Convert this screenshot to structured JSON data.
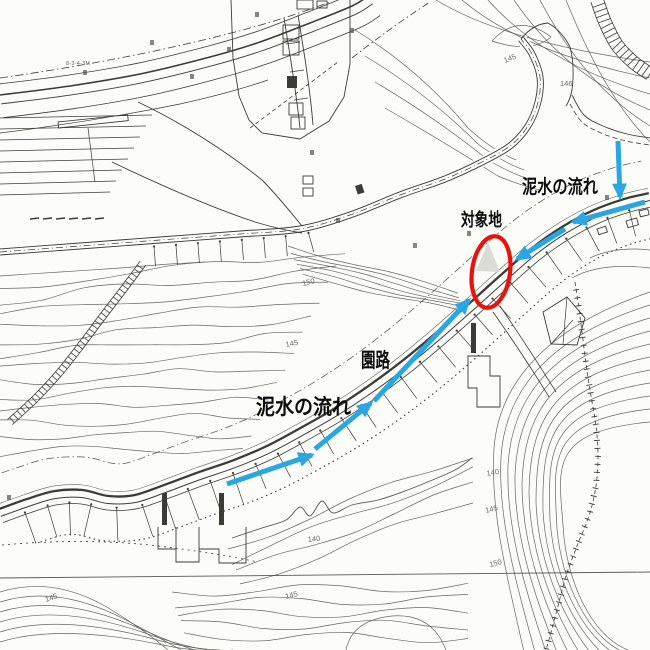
{
  "colors": {
    "paper": "#fcfcf9",
    "ink": "#3c3c36",
    "contour": "#5a5a52",
    "flow_arrow": "#2aa7e2",
    "target_circle": "#e7130e",
    "label_text": "#0d0d0d",
    "contour_label": "#6e6e65",
    "triangle_fill": "#dcdcd6"
  },
  "annotations": {
    "flow_labels": [
      {
        "id": "mud-flow-upper",
        "text": "泥水の流れ",
        "x": 522,
        "y": 193,
        "size": 19,
        "length": 76
      },
      {
        "id": "target-site",
        "text": "対象地",
        "x": 461,
        "y": 226,
        "size": 18,
        "length": 41
      },
      {
        "id": "park-path",
        "text": "園路",
        "x": 361,
        "y": 367,
        "size": 20,
        "length": 29
      },
      {
        "id": "mud-flow-lower",
        "text": "泥水の流れ",
        "x": 256,
        "y": 414,
        "size": 21,
        "length": 95
      }
    ],
    "flow_arrows": [
      {
        "x1": 618,
        "y1": 141,
        "x2": 620,
        "y2": 197
      },
      {
        "x1": 645,
        "y1": 202,
        "x2": 573,
        "y2": 222
      },
      {
        "x1": 565,
        "y1": 229,
        "x2": 517,
        "y2": 259
      },
      {
        "x1": 374,
        "y1": 401,
        "x2": 469,
        "y2": 300
      },
      {
        "x1": 315,
        "y1": 449,
        "x2": 371,
        "y2": 403
      },
      {
        "x1": 227,
        "y1": 484,
        "x2": 312,
        "y2": 455
      }
    ],
    "target_circle": {
      "cx": 491,
      "cy": 272,
      "rx": 19,
      "ry": 36,
      "rotate": 8
    },
    "target_triangle_points": "488,242 476,271 500,272"
  },
  "map_text": {
    "contour_labels": [
      {
        "text": "150",
        "x": 303,
        "y": 286,
        "r": -14
      },
      {
        "text": "145",
        "x": 286,
        "y": 347,
        "r": -10
      },
      {
        "text": "145",
        "x": 505,
        "y": 63,
        "r": -22
      },
      {
        "text": "146",
        "x": 560,
        "y": 86,
        "r": 0
      },
      {
        "text": "140",
        "x": 308,
        "y": 542,
        "r": -6
      },
      {
        "text": "145",
        "x": 286,
        "y": 599,
        "r": -14
      },
      {
        "text": "140",
        "x": 487,
        "y": 476,
        "r": -10
      },
      {
        "text": "145",
        "x": 486,
        "y": 513,
        "r": -14
      },
      {
        "text": "150",
        "x": 490,
        "y": 567,
        "r": -14
      },
      {
        "text": "145",
        "x": 46,
        "y": 602,
        "r": -18
      }
    ],
    "survey_label": {
      "text": "8-3-4-3M",
      "x": 66,
      "y": 65
    }
  }
}
